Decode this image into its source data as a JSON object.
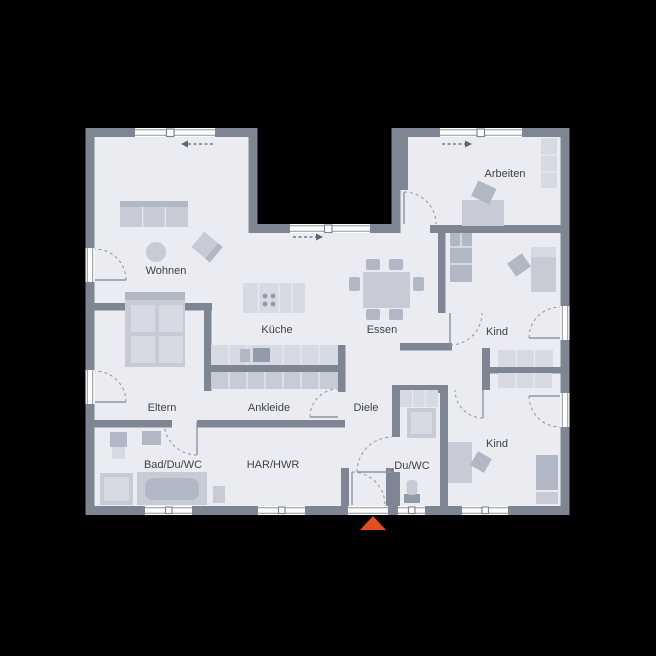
{
  "plan_title": "Erdgeschoss Grundriss Bungalow",
  "rooms": {
    "wohnen": "Wohnen",
    "kueche": "Küche",
    "essen": "Essen",
    "arbeiten": "Arbeiten",
    "kind_1": "Kind",
    "kind_2": "Kind",
    "eltern": "Eltern",
    "ankleide": "Ankleide",
    "diele": "Diele",
    "bad": "Bad/Du/WC",
    "har": "HAR/HWR",
    "du_wc": "Du/WC"
  },
  "colors": {
    "background": "#000000",
    "wall": "#7e8694",
    "floor": "#eaecf1",
    "window": "#ffffff",
    "frame": "#8d94a2",
    "furniture_light": "#d6dae2",
    "furniture_mid": "#c6cbd6",
    "furniture_dark": "#b1b7c4",
    "appliance": "#939bab",
    "arrow": "#5d6370",
    "text": "#3d424d",
    "entrance_accent": "#e14f1e"
  }
}
